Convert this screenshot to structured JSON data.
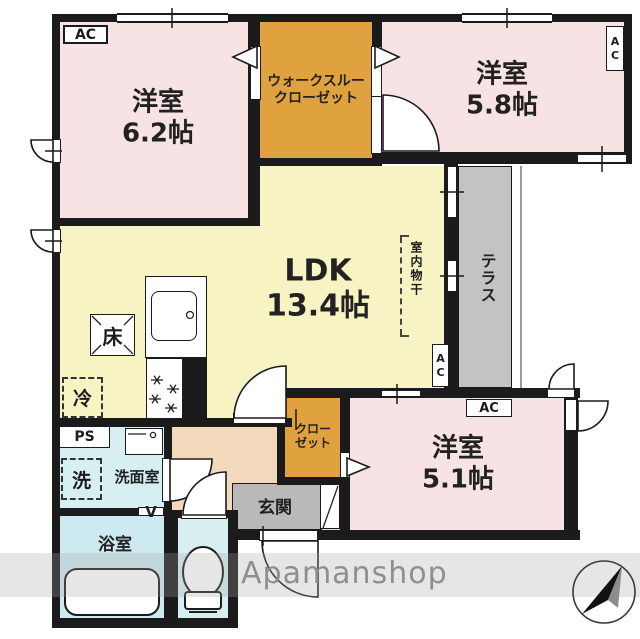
{
  "colors": {
    "wall": "#1b1b1b",
    "room_pink": "#f8e3e4",
    "closet_orange": "#dfa23f",
    "ldk_yellow": "#f8f3c2",
    "terrace_gray": "#c3c3c3",
    "entrance_gray": "#b9b9b9",
    "hall_peach": "#f3d9bc",
    "wet_area_cyan": "#d7eff1",
    "watermark_gray": "#8f8f8f"
  },
  "rooms": {
    "room_62": {
      "name": "洋室",
      "size": "6.2帖"
    },
    "walk_through_closet": {
      "line1": "ウォークスルー",
      "line2": "クローゼット"
    },
    "room_58": {
      "name": "洋室",
      "size": "5.8帖"
    },
    "ldk": {
      "name": "LDK",
      "size": "13.4帖"
    },
    "terrace": {
      "name": "テラス"
    },
    "room_51": {
      "name": "洋室",
      "size": "5.1帖"
    },
    "closet": {
      "line1": "クロー",
      "line2": "ゼット"
    },
    "washroom": {
      "name": "洗面室"
    },
    "bathroom": {
      "name": "浴室"
    },
    "entrance": {
      "name": "玄関"
    }
  },
  "labels": {
    "ac": "AC",
    "floor_storage": "床",
    "refrigerator": "冷",
    "pipe_space": "PS",
    "washing_machine": "洗",
    "vent": "V",
    "indoor_drying": "室内物干"
  },
  "watermark": "Apamanshop"
}
